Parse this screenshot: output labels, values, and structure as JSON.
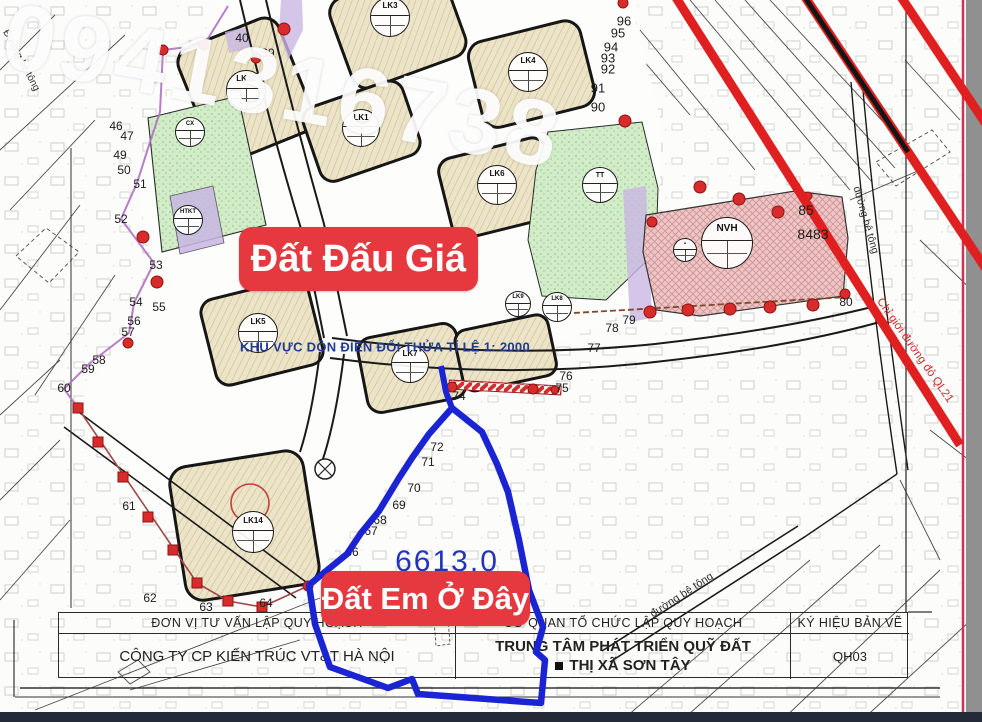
{
  "watermark": {
    "text": "0941316738"
  },
  "labels": {
    "auction": "Đất Đấu Giá",
    "my_land": "Đất Em Ở Đây",
    "area_value": "6613.0",
    "zone_note": "KHU VỰC DỒN ĐIỀN ĐỔI THỬA TỈ LỆ 1: 2000",
    "red_boundary": "Chỉ giới đường đỏ QL21",
    "road_labels": [
      "Đường bê tông",
      "đường bê tông",
      "đường bê tông"
    ]
  },
  "table": {
    "col1": {
      "header": "ĐƠN VỊ TƯ VẤN LẬP QUY HOẠCH",
      "body": "CÔNG TY CP KIẾN TRÚC VT&T HÀ NỘI"
    },
    "col2": {
      "header": "CƠ QUAN TỔ CHỨC LẬP QUY HOẠCH",
      "body_line1": "TRUNG TÂM PHÁT TRIỂN QUỸ ĐẤT",
      "body_line2": "THỊ XÃ SƠN TÂY"
    },
    "col3": {
      "header": "KÝ HIỆU BẢN VẼ",
      "body": "QH03"
    }
  },
  "colors": {
    "tag_red": "#e5383f",
    "parcel_blue": "#1b24d2",
    "note_navy": "#1f3a93",
    "stripe_red": "#e02020",
    "zone_pink": "#eec6c6",
    "zone_green": "#d2ecc8",
    "zone_beige": "#ece4c8",
    "zone_purple": "#c9b6e4"
  },
  "map": {
    "numbers": [
      {
        "t": "40",
        "x": 242,
        "y": 38
      },
      {
        "t": "39",
        "x": 268,
        "y": 53
      },
      {
        "t": "46",
        "x": 116,
        "y": 126
      },
      {
        "t": "47",
        "x": 127,
        "y": 136
      },
      {
        "t": "49",
        "x": 120,
        "y": 155
      },
      {
        "t": "50",
        "x": 124,
        "y": 170
      },
      {
        "t": "51",
        "x": 140,
        "y": 184
      },
      {
        "t": "52",
        "x": 121,
        "y": 219
      },
      {
        "t": "53",
        "x": 156,
        "y": 265
      },
      {
        "t": "54",
        "x": 136,
        "y": 302
      },
      {
        "t": "55",
        "x": 159,
        "y": 307
      },
      {
        "t": "56",
        "x": 134,
        "y": 321
      },
      {
        "t": "57",
        "x": 128,
        "y": 332
      },
      {
        "t": "58",
        "x": 99,
        "y": 360
      },
      {
        "t": "59",
        "x": 88,
        "y": 369
      },
      {
        "t": "60",
        "x": 64,
        "y": 388
      },
      {
        "t": "61",
        "x": 129,
        "y": 506
      },
      {
        "t": "62",
        "x": 150,
        "y": 598
      },
      {
        "t": "63",
        "x": 206,
        "y": 607
      },
      {
        "t": "64",
        "x": 266,
        "y": 603
      },
      {
        "t": "66",
        "x": 352,
        "y": 552
      },
      {
        "t": "67",
        "x": 371,
        "y": 531
      },
      {
        "t": "68",
        "x": 380,
        "y": 520
      },
      {
        "t": "69",
        "x": 399,
        "y": 505
      },
      {
        "t": "70",
        "x": 414,
        "y": 488
      },
      {
        "t": "71",
        "x": 428,
        "y": 462
      },
      {
        "t": "72",
        "x": 437,
        "y": 447
      },
      {
        "t": "74",
        "x": 459,
        "y": 396
      },
      {
        "t": "75",
        "x": 562,
        "y": 388
      },
      {
        "t": "76",
        "x": 566,
        "y": 376
      },
      {
        "t": "77",
        "x": 594,
        "y": 348
      },
      {
        "t": "78",
        "x": 612,
        "y": 328
      },
      {
        "t": "79",
        "x": 629,
        "y": 320
      },
      {
        "t": "80",
        "x": 846,
        "y": 302
      },
      {
        "t": "85",
        "x": 806,
        "y": 210,
        "s": 14
      },
      {
        "t": "8483",
        "x": 813,
        "y": 234,
        "s": 14
      },
      {
        "t": "90",
        "x": 598,
        "y": 107,
        "s": 13
      },
      {
        "t": "91",
        "x": 598,
        "y": 88,
        "s": 13
      },
      {
        "t": "92",
        "x": 608,
        "y": 69,
        "s": 13
      },
      {
        "t": "93",
        "x": 608,
        "y": 58,
        "s": 13
      },
      {
        "t": "94",
        "x": 611,
        "y": 47,
        "s": 13
      },
      {
        "t": "95",
        "x": 618,
        "y": 33,
        "s": 13
      },
      {
        "t": "96",
        "x": 624,
        "y": 21,
        "s": 13
      }
    ],
    "circles": [
      {
        "code": "LK3",
        "x": 390,
        "y": 17,
        "r": 20
      },
      {
        "code": "LK12",
        "x": 246,
        "y": 90,
        "r": 20
      },
      {
        "code": "LK4",
        "x": 528,
        "y": 72,
        "r": 20
      },
      {
        "code": "LK1",
        "x": 361,
        "y": 128,
        "r": 19
      },
      {
        "code": "LK6",
        "x": 497,
        "y": 185,
        "r": 20
      },
      {
        "code": "TT",
        "x": 600,
        "y": 185,
        "r": 18
      },
      {
        "code": "CX",
        "x": 190,
        "y": 132,
        "r": 15
      },
      {
        "code": "HTKT",
        "x": 188,
        "y": 220,
        "r": 15
      },
      {
        "code": "LK5",
        "x": 258,
        "y": 333,
        "r": 20
      },
      {
        "code": "LK7",
        "x": 410,
        "y": 364,
        "r": 19
      },
      {
        "code": "LK9",
        "x": 518,
        "y": 304,
        "r": 13
      },
      {
        "code": "LK8",
        "x": 557,
        "y": 307,
        "r": 15
      },
      {
        "code": "LK14",
        "x": 253,
        "y": 532,
        "r": 21
      },
      {
        "code": "NVH",
        "x": 727,
        "y": 243,
        "r": 26
      },
      {
        "code": "▪",
        "x": 685,
        "y": 250,
        "r": 12
      }
    ]
  }
}
